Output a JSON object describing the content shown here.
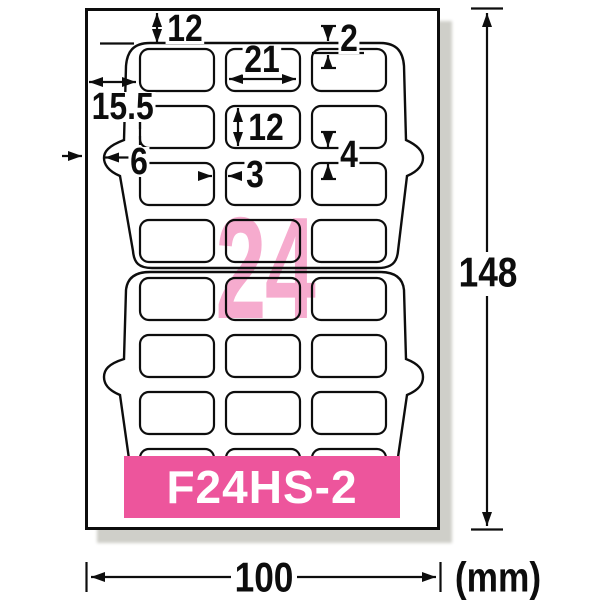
{
  "diagram": {
    "product_code": "F24HS-2",
    "label_count": "24",
    "unit_label": "(mm)",
    "dims": {
      "top_margin": "12",
      "label_width": "21",
      "outline_gap": "2",
      "left_margin": "15.5",
      "notch_offset": "6",
      "column_gap": "3",
      "label_height": "12",
      "row_gap": "4",
      "sheet_height": "148",
      "sheet_width": "100"
    },
    "grid": {
      "rows": 8,
      "cols": 3
    },
    "colors": {
      "banner_pink": "#ed559c",
      "count_pink": "#f6abce",
      "ink": "#0d0d0d",
      "shadow": "#cfcfc9"
    }
  }
}
